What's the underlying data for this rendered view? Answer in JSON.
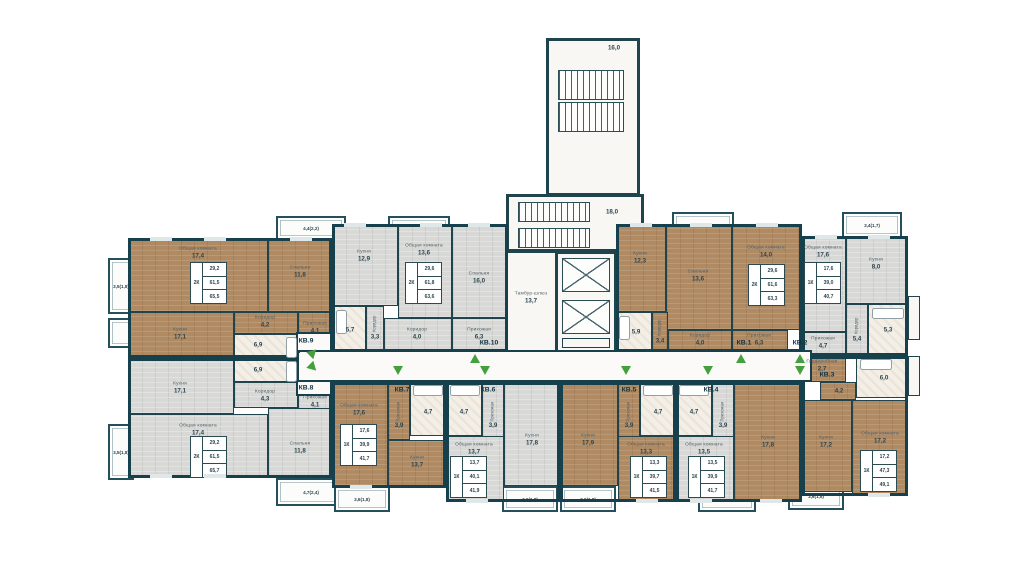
{
  "apts": {
    "kv9": {
      "num": "КВ.9",
      "type": "2К",
      "stats": {
        "s1": "29,2",
        "s2": "61,5",
        "s3": "65,5"
      },
      "rooms": {
        "living": {
          "n": "Общая комната",
          "a": "17,4"
        },
        "bed": {
          "n": "Спальня",
          "a": "11,8"
        },
        "kitchen": {
          "n": "Кухня",
          "a": "17,1"
        },
        "cor": {
          "n": "Коридор",
          "a": "4,2"
        },
        "hall": {
          "n": "Прихожая",
          "a": "4,1"
        },
        "bath": {
          "a": "6,9"
        }
      }
    },
    "kv8": {
      "num": "КВ.8",
      "type": "2К",
      "stats": {
        "s1": "29,2",
        "s2": "61,5",
        "s3": "65,7"
      },
      "rooms": {
        "living": {
          "n": "Общая комната",
          "a": "17,4"
        },
        "bed": {
          "n": "Спальня",
          "a": "11,8"
        },
        "kitchen": {
          "n": "Кухня",
          "a": "17,1"
        },
        "cor": {
          "n": "Коридор",
          "a": "4,3"
        },
        "hall": {
          "n": "Прихожая",
          "a": "4,1"
        },
        "bath": {
          "a": "6,9"
        }
      }
    },
    "kv10": {
      "num": "КВ.10",
      "type": "2К",
      "stats": {
        "s1": "29,6",
        "s2": "61,8",
        "s3": "63,6"
      },
      "rooms": {
        "kitchen": {
          "n": "Кухня",
          "a": "12,9"
        },
        "living": {
          "n": "Общая комната",
          "a": "13,6"
        },
        "bed": {
          "n": "Спальня",
          "a": "16,0"
        },
        "bath": {
          "a": "5,7"
        },
        "cor1": {
          "n": "Коридор",
          "a": "3,3"
        },
        "cor2": {
          "n": "Коридор",
          "a": "4,0"
        },
        "hall": {
          "n": "Прихожая",
          "a": "6,3"
        }
      }
    },
    "kv1": {
      "num": "КВ.1",
      "type": "2К",
      "stats": {
        "s1": "29,6",
        "s2": "61,6",
        "s3": "63,3"
      },
      "rooms": {
        "kitchen": {
          "n": "Кухня",
          "a": "12,3"
        },
        "bed": {
          "n": "Спальня",
          "a": "13,6"
        },
        "living": {
          "n": "Общая комната",
          "a": "14,0"
        },
        "bath": {
          "a": "5,9"
        },
        "cor1": {
          "n": "Коридор",
          "a": "3,4"
        },
        "cor2": {
          "n": "Коридор",
          "a": "4,0"
        },
        "hall": {
          "n": "Прихожая",
          "a": "6,3"
        }
      }
    },
    "kv2": {
      "num": "КВ.2",
      "type": "1К",
      "stats": {
        "s1": "17,6",
        "s2": "39,0",
        "s3": "40,7"
      },
      "rooms": {
        "living": {
          "n": "Общая комната",
          "a": "17,6"
        },
        "kitchen": {
          "n": "Кухня",
          "a": "8,0"
        },
        "cor": {
          "n": "Коридор",
          "a": "5,4"
        },
        "bath": {
          "a": "5,3"
        },
        "hall": {
          "n": "Прихожая",
          "a": "4,7"
        }
      }
    },
    "kv3": {
      "num": "КВ.3",
      "type": "1К",
      "stats": {
        "s1": "17,2",
        "s2": "47,3",
        "s3": "49,1"
      },
      "rooms": {
        "ward": {
          "n": "Гардеробная",
          "a": "2,7"
        },
        "bath": {
          "a": "6,0"
        },
        "cor": {
          "n": "Коридор",
          "a": "4,2"
        },
        "kitchen": {
          "n": "Кухня",
          "a": "17,2"
        },
        "living": {
          "n": "Общая комната",
          "a": "17,2"
        }
      }
    },
    "kv7": {
      "num": "КВ.7",
      "type": "1К",
      "stats": {
        "s1": "17,6",
        "s2": "39,9",
        "s3": "41,7"
      },
      "rooms": {
        "living": {
          "n": "Общая комната",
          "a": "17,6"
        },
        "kitchen": {
          "n": "Кухня",
          "a": "13,7"
        },
        "hall": {
          "n": "Прихожая",
          "a": "3,9"
        },
        "bath": {
          "a": "4,7"
        }
      }
    },
    "kv6": {
      "num": "КВ.6",
      "type": "1К",
      "stats": {
        "s1": "13,7",
        "s2": "40,1",
        "s3": "41,9"
      },
      "rooms": {
        "living": {
          "n": "Общая комната",
          "a": "13,7"
        },
        "kitchen": {
          "n": "Кухня",
          "a": "17,8"
        },
        "hall": {
          "n": "Прихожая",
          "a": "3,9"
        },
        "bath": {
          "a": "4,7"
        }
      }
    },
    "kv5": {
      "num": "КВ.5",
      "type": "1К",
      "stats": {
        "s1": "13,3",
        "s2": "39,7",
        "s3": "41,5"
      },
      "rooms": {
        "living": {
          "n": "Общая комната",
          "a": "13,3"
        },
        "kitchen": {
          "n": "Кухня",
          "a": "17,9"
        },
        "hall": {
          "n": "Прихожая",
          "a": "3,9"
        },
        "bath": {
          "a": "4,7"
        }
      }
    },
    "kv4": {
      "num": "КВ.4",
      "type": "1К",
      "stats": {
        "s1": "13,5",
        "s2": "39,9",
        "s3": "41,7"
      },
      "rooms": {
        "living": {
          "n": "Общая комната",
          "a": "13,5"
        },
        "kitchen": {
          "n": "Кухня",
          "a": "17,8"
        },
        "hall": {
          "n": "Прихожая",
          "a": "3,9"
        },
        "bath": {
          "a": "4,7"
        }
      }
    }
  },
  "core": {
    "stairs": "18,0",
    "tower": "16,0",
    "vestibule": {
      "n": "Тамбур-шлюз",
      "a": "13,7"
    }
  },
  "balconies": {
    "b1": "3,5(1,8)",
    "b2": "4,4(2,2)",
    "b3": "3,6(1,8)",
    "b4": "3,5(1,7)",
    "b5": "3,4(1,7)",
    "b6": "3,5(1,8)",
    "b7": "4,7(2,4)",
    "b8": "3,6(1,8)",
    "b9": "3,6(1,8)",
    "b10": "3,6(1,8)",
    "b11": "3,6(1,8)",
    "b12": "3,6(1,8)"
  }
}
